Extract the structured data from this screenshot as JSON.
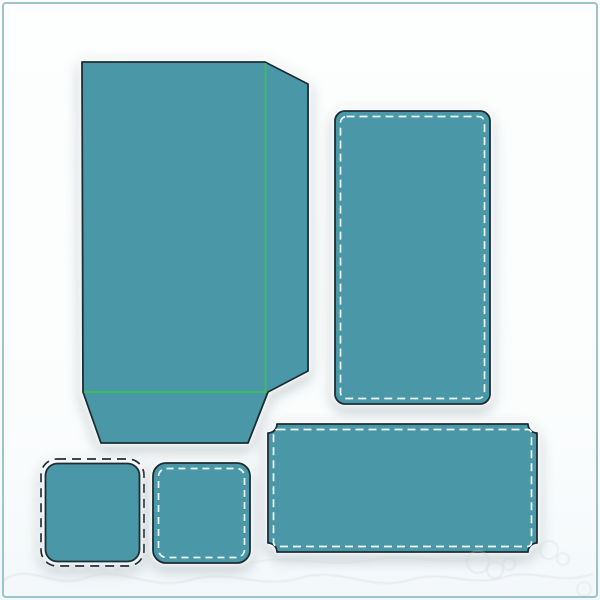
{
  "canvas": {
    "width": 600,
    "height": 600,
    "background": "#fdfefe",
    "frame_color": "#9cc4d0"
  },
  "palette": {
    "piece_fill": "#4a98a7",
    "cut_outline": "#1d2d36",
    "fold_line_green": "#3dbd55",
    "stitch_white": "#f0fafa",
    "outer_dash_black": "#22313a",
    "watermark_gray": "#c9d4d8"
  },
  "groups": [
    {
      "name": "envelope-piece",
      "kind": "piece",
      "nodes": [
        {
          "type": "polygon",
          "name": "envelope-cut-outline",
          "attrs": {
            "points": "82,62 265,62 308,84 308,371 268,392 248,443 101,443 83,392",
            "fill": "@piece_fill",
            "stroke": "@cut_outline",
            "stroke-width": "1.8",
            "stroke-linejoin": "round"
          }
        },
        {
          "type": "line",
          "name": "fold-line-vertical",
          "attrs": {
            "x1": "265.5",
            "y1": "63",
            "x2": "265.5",
            "y2": "391",
            "stroke": "@fold_line_green",
            "stroke-width": "1.8"
          }
        },
        {
          "type": "line",
          "name": "fold-line-horizontal",
          "attrs": {
            "x1": "84",
            "y1": "392",
            "x2": "267",
            "y2": "392",
            "stroke": "@fold_line_green",
            "stroke-width": "1.8"
          }
        }
      ]
    },
    {
      "name": "stitched-panel-piece",
      "kind": "piece",
      "nodes": [
        {
          "type": "rect",
          "name": "panel-cut-outline",
          "attrs": {
            "x": "335",
            "y": "111",
            "width": "155",
            "height": "293",
            "rx": "10",
            "fill": "@piece_fill",
            "stroke": "@cut_outline",
            "stroke-width": "1.8"
          }
        },
        {
          "type": "rect",
          "name": "panel-stitch-line",
          "attrs": {
            "x": "340.5",
            "y": "116.5",
            "width": "144",
            "height": "282",
            "rx": "6",
            "fill": "none",
            "stroke": "@stitch_white",
            "stroke-width": "1.7",
            "stroke-dasharray": "8 5"
          }
        }
      ]
    },
    {
      "name": "ticket-piece",
      "kind": "piece",
      "nodes": [
        {
          "type": "path",
          "name": "ticket-cut-outline",
          "attrs": {
            "d": "M 277 424 L 528 424 A 9 9 0 0 0 537 433 L 537 543 A 9 9 0 0 0 528 552 L 277 552 A 9 9 0 0 0 268 543 L 268 433 A 9 9 0 0 0 277 424 Z",
            "fill": "@piece_fill",
            "stroke": "@cut_outline",
            "stroke-width": "1.8",
            "stroke-linejoin": "round"
          }
        },
        {
          "type": "rect",
          "name": "ticket-stitch-line",
          "attrs": {
            "x": "273.5",
            "y": "429.5",
            "width": "258",
            "height": "117",
            "rx": "4",
            "fill": "none",
            "stroke": "@stitch_white",
            "stroke-width": "1.7",
            "stroke-dasharray": "8 5"
          }
        }
      ]
    },
    {
      "name": "small-square-cut-piece",
      "kind": "piece",
      "nodes": [
        {
          "type": "rect",
          "name": "small-square-outer-dash-line",
          "attrs": {
            "x": "41",
            "y": "459",
            "width": "103",
            "height": "107",
            "rx": "16",
            "fill": "none",
            "stroke": "@outer_dash_black",
            "stroke-width": "1.7",
            "stroke-dasharray": "9 6"
          }
        },
        {
          "type": "rect",
          "name": "small-square-cut-outline",
          "attrs": {
            "x": "45.5",
            "y": "463.5",
            "width": "94",
            "height": "98",
            "rx": "12",
            "fill": "@piece_fill",
            "stroke": "@cut_outline",
            "stroke-width": "1.8"
          }
        }
      ]
    },
    {
      "name": "small-square-stitched-piece",
      "kind": "piece",
      "nodes": [
        {
          "type": "rect",
          "name": "small-square-stitched-cut-outline",
          "attrs": {
            "x": "153",
            "y": "463",
            "width": "97",
            "height": "100",
            "rx": "13",
            "fill": "@piece_fill",
            "stroke": "@cut_outline",
            "stroke-width": "1.8"
          }
        },
        {
          "type": "rect",
          "name": "small-square-stitch-line",
          "attrs": {
            "x": "158.5",
            "y": "468.5",
            "width": "86",
            "height": "89",
            "rx": "8",
            "fill": "none",
            "stroke": "@stitch_white",
            "stroke-width": "1.7",
            "stroke-dasharray": "7 5"
          }
        }
      ]
    },
    {
      "name": "watermark",
      "kind": "watermark",
      "opacity": "0.55",
      "nodes": [
        {
          "type": "path",
          "name": "watermark-flourish-stroke",
          "attrs": {
            "d": "M 4 580 C 30 562 55 590 85 578 C 120 564 150 592 190 580 C 230 568 260 590 300 578 C 340 566 370 592 410 580 C 445 569 470 588 505 577 C 535 568 560 586 592 574",
            "fill": "none",
            "stroke": "@watermark_gray",
            "stroke-width": "2.2",
            "stroke-linecap": "round",
            "opacity": "0.55"
          }
        },
        {
          "type": "path",
          "name": "watermark-flourish-stroke-2",
          "attrs": {
            "d": "M 250 563 C 290 553 330 569 370 560 C 410 551 450 567 470 559",
            "fill": "none",
            "stroke": "@watermark_gray",
            "stroke-width": "2",
            "stroke-linecap": "round",
            "opacity": "0.45"
          }
        },
        {
          "type": "circle",
          "name": "watermark-doodle-circle",
          "attrs": {
            "cx": "478",
            "cy": "562",
            "r": "11",
            "fill": "none",
            "stroke": "@watermark_gray",
            "stroke-width": "2",
            "opacity": "0.6"
          }
        },
        {
          "type": "circle",
          "name": "watermark-doodle-circle",
          "attrs": {
            "cx": "495",
            "cy": "570",
            "r": "8",
            "fill": "none",
            "stroke": "@watermark_gray",
            "stroke-width": "2",
            "opacity": "0.6"
          }
        },
        {
          "type": "circle",
          "name": "watermark-doodle-circle",
          "attrs": {
            "cx": "509",
            "cy": "564",
            "r": "6",
            "fill": "none",
            "stroke": "@watermark_gray",
            "stroke-width": "2",
            "opacity": "0.55"
          }
        },
        {
          "type": "circle",
          "name": "watermark-doodle-circle",
          "attrs": {
            "cx": "549",
            "cy": "550",
            "r": "9",
            "fill": "none",
            "stroke": "@watermark_gray",
            "stroke-width": "2",
            "opacity": "0.5"
          }
        },
        {
          "type": "circle",
          "name": "watermark-doodle-circle",
          "attrs": {
            "cx": "563",
            "cy": "559",
            "r": "6",
            "fill": "none",
            "stroke": "@watermark_gray",
            "stroke-width": "2",
            "opacity": "0.5"
          }
        },
        {
          "type": "circle",
          "name": "watermark-doodle-circle",
          "attrs": {
            "cx": "584",
            "cy": "589",
            "r": "7",
            "fill": "none",
            "stroke": "@watermark_gray",
            "stroke-width": "2",
            "opacity": "0.45"
          }
        }
      ]
    }
  ]
}
